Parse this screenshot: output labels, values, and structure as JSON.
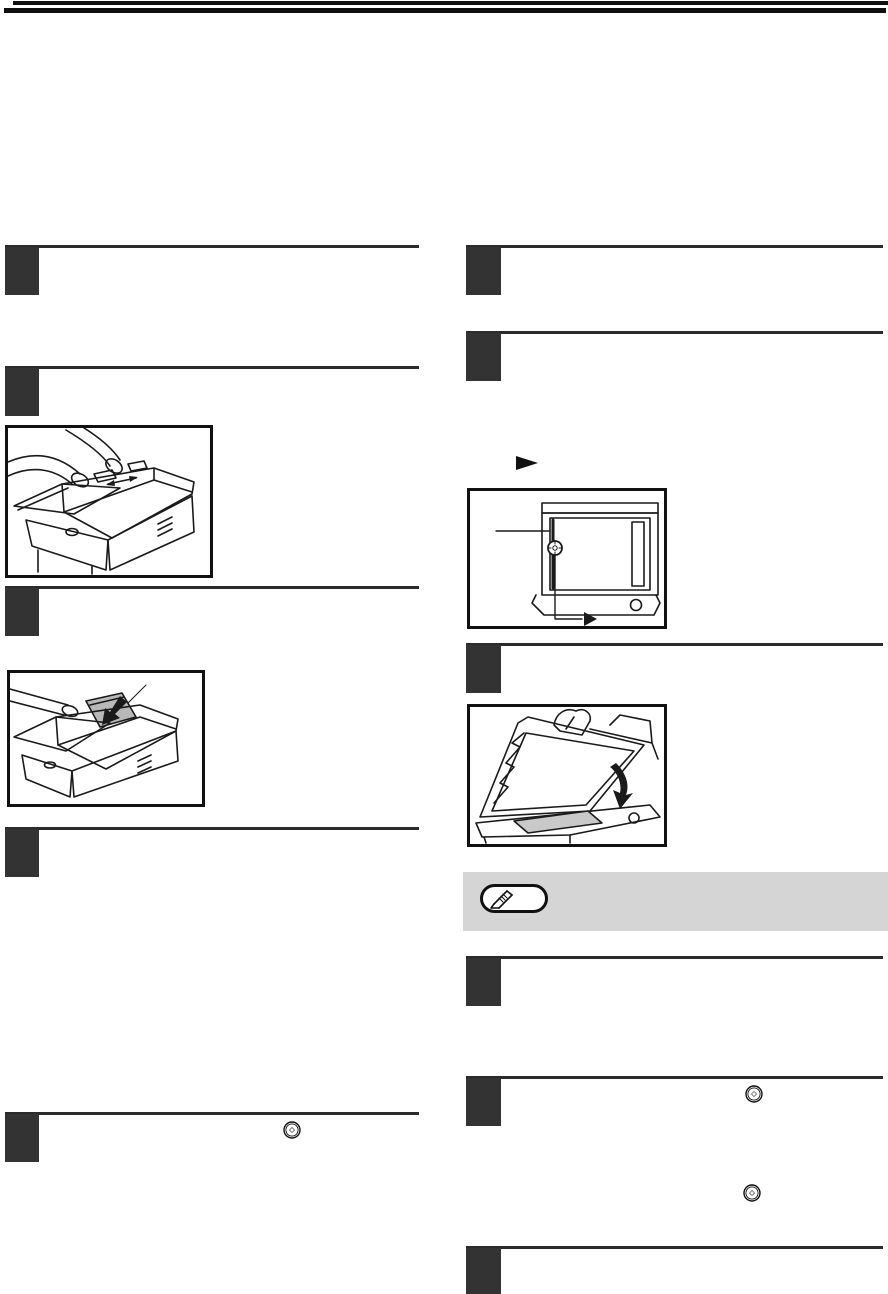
{
  "document": {
    "kind": "scanned-user-manual-page",
    "description": "Copier operation manual page; body text not rendered, only structural graphics visible",
    "visible_text": ""
  },
  "colors": {
    "page_background": "#ffffff",
    "header_bar": "#0f0f0f",
    "step_marker": "#333333",
    "step_rule": "#2b2b2b",
    "note_background": "#d5d5d5",
    "line_art": "#1a1a1a",
    "paper_gray": "#b9b9b9",
    "glass_gray": "#c9c9c9"
  },
  "steps": {
    "left_column_marker_count": 5,
    "right_column_marker_count": 6,
    "marker_label": ""
  },
  "icons": {
    "arrow_right_glyph": "►",
    "pencil": "pencil-icon",
    "start_button": "start-button-icon"
  },
  "illustrations": [
    {
      "name": "adf-guide-adjustment",
      "column": "left",
      "content": "hands adjusting document feeder guides on copier"
    },
    {
      "name": "original-into-feeder",
      "column": "left",
      "content": "gray original inserted into document feeder tray with black arrow"
    },
    {
      "name": "document-glass-top-view",
      "column": "right",
      "content": "top view of document glass with scale marker, callout lines and arrow"
    },
    {
      "name": "closing-document-cover",
      "column": "right",
      "content": "hand closing document cover over original on glass, curved arrow"
    }
  ],
  "note": {
    "text": "",
    "has_pencil_badge": true
  }
}
